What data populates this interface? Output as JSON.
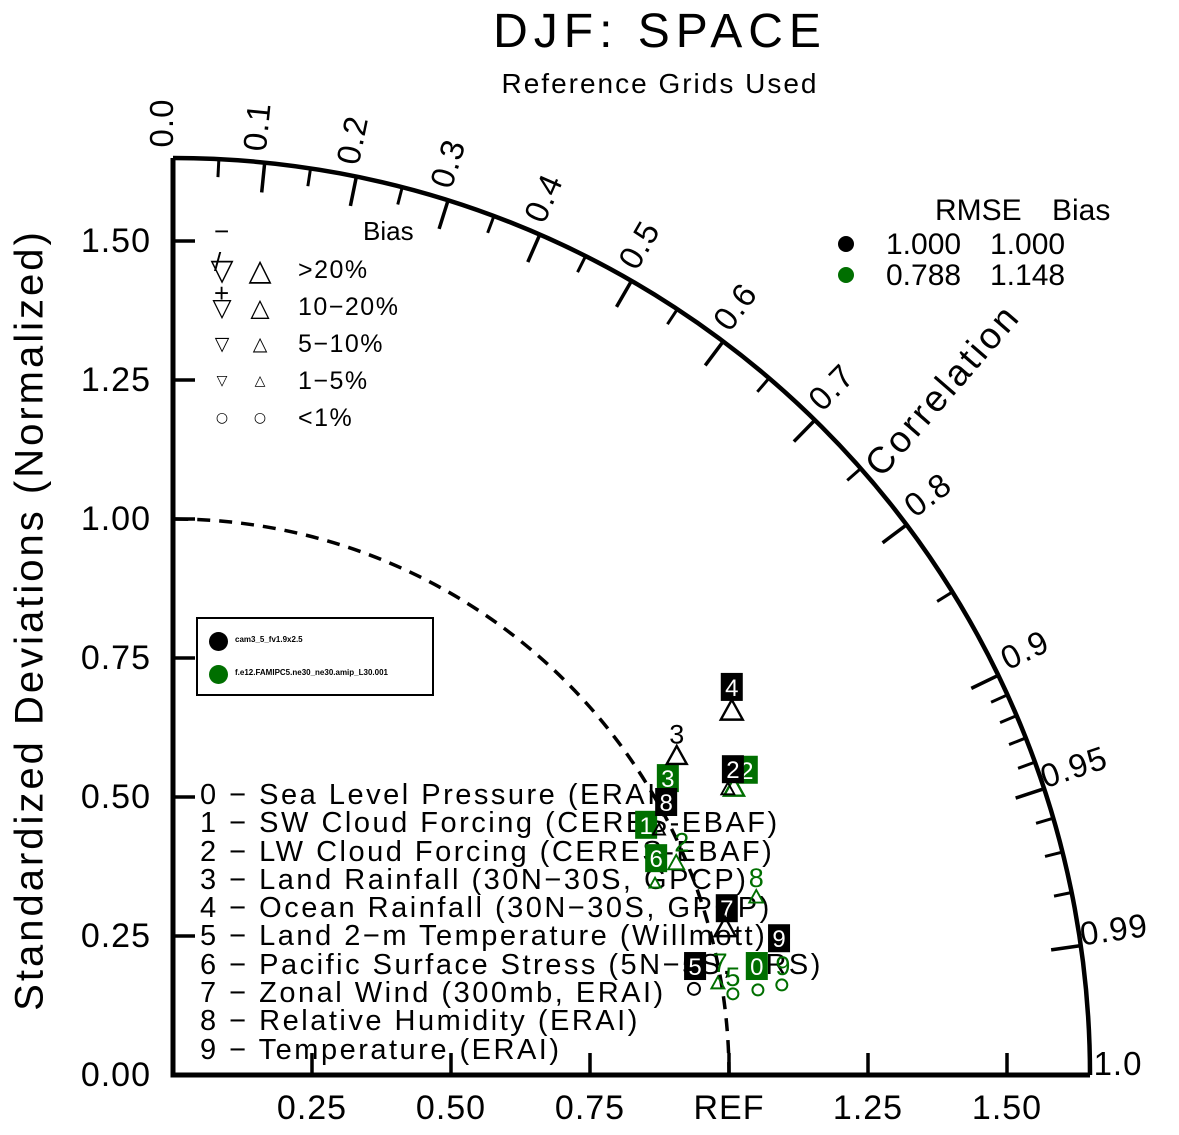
{
  "title": "DJF: SPACE",
  "subtitle": "Reference Grids Used",
  "ylabel": "Standardized Deviations (Normalized)",
  "bias_legend": {
    "header": {
      "ops": "− / +",
      "title": "Bias"
    },
    "rows": [
      {
        "down": "▽",
        "up": "△",
        "label": ">20%",
        "sym_px": 30
      },
      {
        "down": "▽",
        "up": "△",
        "label": "10−20%",
        "sym_px": 25
      },
      {
        "down": "▽",
        "up": "△",
        "label": "5−10%",
        "sym_px": 19
      },
      {
        "down": "▽",
        "up": "△",
        "label": "1−5%",
        "sym_px": 14
      },
      {
        "down": "○",
        "up": "○",
        "label": "<1%",
        "sym_px": 14
      }
    ]
  },
  "rmse_legend": {
    "rmse_header": "RMSE",
    "bias_header": "Bias",
    "rows": [
      {
        "color": "#000000",
        "rmse": "1.000",
        "bias": "1.000"
      },
      {
        "color": "#006f00",
        "rmse": "0.788",
        "bias": "1.148"
      }
    ]
  },
  "model_legend": {
    "models": [
      {
        "color": "#000000",
        "name": "cam3_5_fv1.9x2.5"
      },
      {
        "color": "#006f00",
        "name": "f.e12.FAMIPC5.ne30_ne30.amip_L30.001"
      }
    ]
  },
  "variables": [
    "0 − Sea Level Pressure (ERAI)",
    "1 − SW Cloud Forcing (CERES-EBAF)",
    "2 − LW Cloud Forcing (CERES-EBAF)",
    "3 − Land Rainfall (30N−30S, GPCP)",
    "4 − Ocean Rainfall (30N−30S, GPCP)",
    "5 − Land 2−m Temperature (Willmott)",
    "6 − Pacific Surface Stress (5N−5S, ERS)",
    "7 − Zonal Wind (300mb, ERAI)",
    "8 − Relative Humidity (ERAI)",
    "9 − Temperature (ERAI)"
  ],
  "chart_data": {
    "type": "taylor",
    "title": "DJF: SPACE",
    "subtitle": "Reference Grids Used",
    "ylabel": "Standardized Deviations (Normalized)",
    "correlation_label": "Correlation",
    "std_max": 1.65,
    "ref_std": 1.0,
    "geometry": {
      "cx": 173,
      "cy": 1075,
      "unit": 556,
      "radius": 917,
      "label_radius": 952
    },
    "x_ticks": [
      {
        "v": 0.25,
        "label": "0.25"
      },
      {
        "v": 0.5,
        "label": "0.50"
      },
      {
        "v": 0.75,
        "label": "0.75"
      },
      {
        "v": 1.0,
        "label": "REF"
      },
      {
        "v": 1.25,
        "label": "1.25"
      },
      {
        "v": 1.5,
        "label": "1.50"
      }
    ],
    "y_ticks": [
      {
        "v": 0,
        "label": "0.00"
      },
      {
        "v": 0.25,
        "label": "0.25"
      },
      {
        "v": 0.5,
        "label": "0.50"
      },
      {
        "v": 0.75,
        "label": "0.75"
      },
      {
        "v": 1.0,
        "label": "1.00"
      },
      {
        "v": 1.25,
        "label": "1.25"
      },
      {
        "v": 1.5,
        "label": "1.50"
      }
    ],
    "corr_labels": [
      {
        "v": 0.0,
        "label": "0.0"
      },
      {
        "v": 0.1,
        "label": "0.1"
      },
      {
        "v": 0.2,
        "label": "0.2"
      },
      {
        "v": 0.3,
        "label": "0.3"
      },
      {
        "v": 0.4,
        "label": "0.4"
      },
      {
        "v": 0.5,
        "label": "0.5"
      },
      {
        "v": 0.6,
        "label": "0.6"
      },
      {
        "v": 0.7,
        "label": "0.7"
      },
      {
        "v": 0.8,
        "label": "0.8"
      },
      {
        "v": 0.9,
        "label": "0.9"
      },
      {
        "v": 0.95,
        "label": "0.95"
      },
      {
        "v": 0.99,
        "label": "0.99"
      },
      {
        "v": 1.0,
        "label": "1.0",
        "r": 945
      }
    ],
    "corr_ticks_major": [
      0.1,
      0.2,
      0.3,
      0.4,
      0.5,
      0.6,
      0.7,
      0.8,
      0.9,
      0.95,
      0.99
    ],
    "corr_ticks_minor": [
      0.05,
      0.15,
      0.25,
      0.35,
      0.45,
      0.55,
      0.65,
      0.75,
      0.85,
      0.91,
      0.92,
      0.93,
      0.94,
      0.96,
      0.97,
      0.98
    ],
    "series": [
      {
        "name": "cam3_5_fv1.9x2.5",
        "color": "#000000",
        "rmse": 1.0,
        "bias": 1.0,
        "markers": [
          {
            "t": "box",
            "v": "4",
            "x": 1.005,
            "y": 0.698
          },
          {
            "t": "tri",
            "x": 1.005,
            "y": 0.653,
            "s": 22
          },
          {
            "t": "digit",
            "v": "3",
            "x": 0.906,
            "y": 0.612
          },
          {
            "t": "tri",
            "x": 0.906,
            "y": 0.572,
            "s": 20
          },
          {
            "t": "box",
            "v": "2",
            "x": 1.007,
            "y": 0.55
          },
          {
            "t": "tri",
            "x": 0.998,
            "y": 0.513,
            "s": 13
          },
          {
            "t": "box",
            "v": "8",
            "x": 0.887,
            "y": 0.491
          },
          {
            "t": "tri",
            "x": 0.874,
            "y": 0.44,
            "s": 12
          },
          {
            "t": "box",
            "v": "7",
            "x": 0.996,
            "y": 0.3
          },
          {
            "t": "tri",
            "x": 0.993,
            "y": 0.263,
            "s": 21
          },
          {
            "t": "box",
            "v": "9",
            "x": 1.09,
            "y": 0.246
          },
          {
            "t": "box",
            "v": "5",
            "x": 0.939,
            "y": 0.196
          },
          {
            "t": "circle",
            "x": 0.937,
            "y": 0.155,
            "s": 12
          }
        ]
      },
      {
        "name": "f.e12.FAMIPC5.ne30_ne30.amip_L30.001",
        "color": "#006f00",
        "rmse": 0.788,
        "bias": 1.148,
        "markers": [
          {
            "t": "box",
            "v": "2",
            "x": 1.032,
            "y": 0.549
          },
          {
            "t": "tri",
            "x": 1.009,
            "y": 0.515,
            "s": 20
          },
          {
            "t": "box",
            "v": "3",
            "x": 0.89,
            "y": 0.534
          },
          {
            "t": "box",
            "v": "1",
            "x": 0.851,
            "y": 0.45
          },
          {
            "t": "digit",
            "v": "2",
            "x": 0.915,
            "y": 0.418
          },
          {
            "t": "tri",
            "x": 0.905,
            "y": 0.38,
            "s": 16
          },
          {
            "t": "box",
            "v": "6",
            "x": 0.869,
            "y": 0.39
          },
          {
            "t": "tri",
            "x": 0.867,
            "y": 0.344,
            "s": 11
          },
          {
            "t": "digit",
            "v": "8",
            "x": 1.049,
            "y": 0.354
          },
          {
            "t": "tri",
            "x": 1.049,
            "y": 0.319,
            "s": 14
          },
          {
            "t": "digit",
            "v": "7",
            "x": 0.984,
            "y": 0.201
          },
          {
            "t": "tri",
            "x": 0.98,
            "y": 0.164,
            "s": 13
          },
          {
            "t": "digit",
            "v": "5",
            "x": 1.007,
            "y": 0.176
          },
          {
            "t": "circle",
            "x": 1.007,
            "y": 0.146,
            "s": 11
          },
          {
            "t": "box",
            "v": "0",
            "x": 1.05,
            "y": 0.196
          },
          {
            "t": "circle",
            "x": 1.052,
            "y": 0.153,
            "s": 11
          },
          {
            "t": "digit",
            "v": "9",
            "x": 1.097,
            "y": 0.196
          },
          {
            "t": "circle",
            "x": 1.095,
            "y": 0.162,
            "s": 11
          }
        ]
      }
    ]
  }
}
